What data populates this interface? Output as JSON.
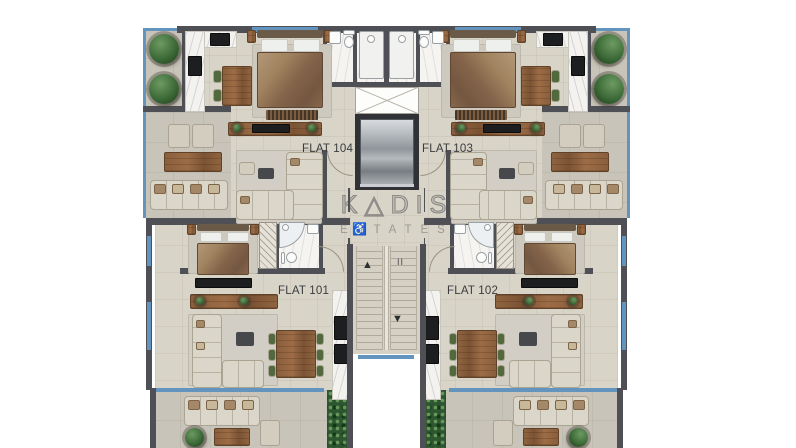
{
  "meta": {
    "type": "architectural floor plan",
    "view": "top-down furnished plan"
  },
  "watermark": {
    "brand": "KADIS",
    "display": "K△DIS",
    "tagline": "ESTATES"
  },
  "flats": {
    "flat104": {
      "label": "FLAT 104"
    },
    "flat103": {
      "label": "FLAT 103"
    },
    "flat101": {
      "label": "FLAT 101"
    },
    "flat102": {
      "label": "FLAT 102"
    }
  },
  "core": {
    "stairs_up_arrow": "▲",
    "stairs_down_arrow": "▼",
    "stairs_level_mark": "II",
    "accessibility_icon": "♿"
  },
  "colors": {
    "wall": "#4f5055",
    "floor": "#d9d4c8",
    "balcony": "#c8c4b9",
    "glass": "#6394bd",
    "sofa": "#dad6ca",
    "wood": "#8a5f3d",
    "plant": "#3d6b38",
    "hedge": "#2d5530",
    "appliance": "#1d1e20",
    "label_text": "#3b3c3e",
    "watermark": "rgba(78,78,82,0.55)"
  }
}
